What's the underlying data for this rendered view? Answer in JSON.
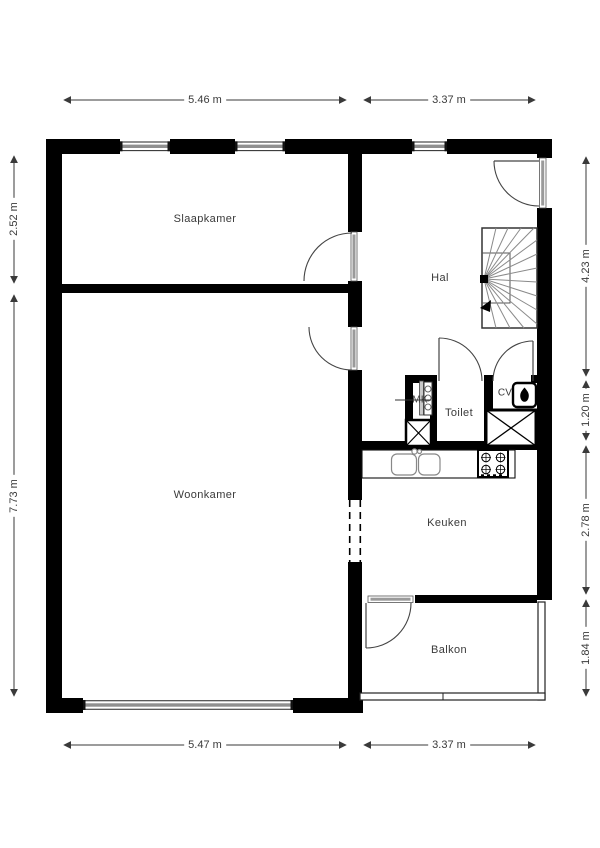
{
  "rooms": {
    "slaapkamer": {
      "label": "Slaapkamer"
    },
    "woonkamer": {
      "label": "Woonkamer"
    },
    "hal": {
      "label": "Hal"
    },
    "toilet": {
      "label": "Toilet"
    },
    "keuken": {
      "label": "Keuken"
    },
    "balkon": {
      "label": "Balkon"
    },
    "cv": {
      "label": "CV"
    },
    "mk": {
      "label": "MK"
    }
  },
  "dimensions": {
    "top_left": "5.46 m",
    "top_right": "3.37 m",
    "bottom_left": "5.47 m",
    "bottom_right": "3.37 m",
    "left_upper": "2.52 m",
    "left_lower": "7.73 m",
    "right_1": "4.23 m",
    "right_2": "1.20 m",
    "right_3": "2.78 m",
    "right_4": "1.84 m"
  },
  "colors": {
    "wall": "#000000",
    "line": "#3a3a3a",
    "window_core": "#8f8f8f",
    "background": "#ffffff"
  }
}
